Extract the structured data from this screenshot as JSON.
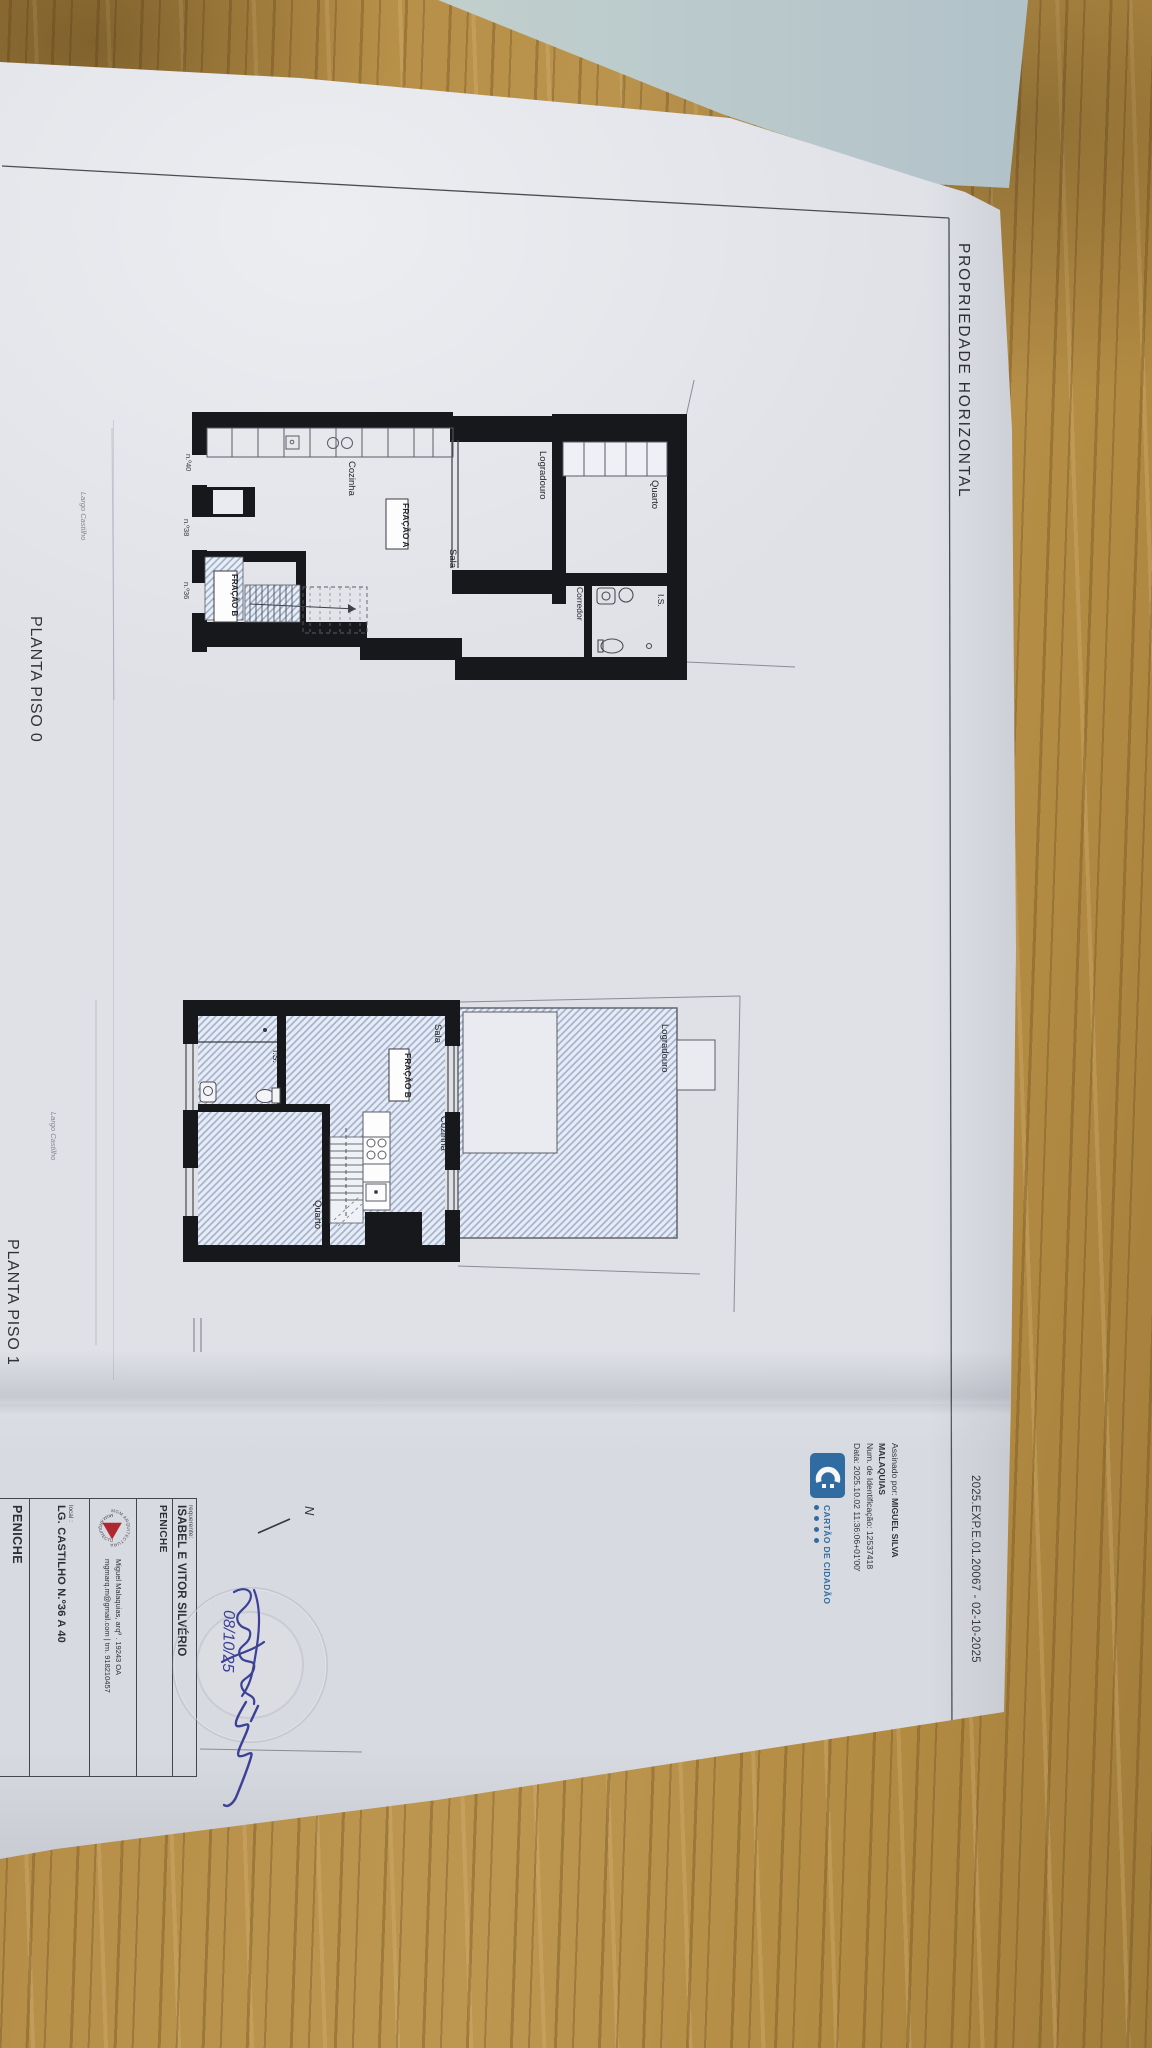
{
  "document": {
    "header": "PROPRIEDADE HORIZONTAL",
    "reference": "2025.EXP.E.01.20067 - 02-10-2025",
    "digital_signature": {
      "signed_by_label": "Assinado por:",
      "name_line1": "MIGUEL SILVA",
      "name_line2": "MALAQUIAS",
      "id_line": "Num. de Identificação: 12537418",
      "date_line": "Data: 2025.10.02 11:36:06+01'00'"
    },
    "citizen_card": {
      "wordmark": "CARTÃO DE CIDADÃO"
    },
    "plans": {
      "piso0": {
        "caption": "PLANTA PISO 0",
        "street_label": "Largo Castilho",
        "rooms": {
          "cozinha": "Cozinha",
          "sala": "Sala",
          "quarto": "Quarto",
          "corredor": "Corredor",
          "is": "I.S.",
          "logradouro": "Logradouro"
        },
        "fracao_a": "FRAÇÃO A",
        "fracao_b": "FRAÇÃO B",
        "doors": [
          "n.º40",
          "n.º38",
          "n.º36"
        ]
      },
      "piso1": {
        "caption": "PLANTA PISO 1",
        "street_label": "Largo Castilho",
        "rooms": {
          "sala": "Sala",
          "cozinha": "Cozinha",
          "quarto": "Quarto",
          "is": "I.S.",
          "logradouro": "Logradouro"
        },
        "fracao_b": "FRAÇÃO B"
      }
    },
    "title_block": {
      "requerente_label": "requerente:",
      "requerente": "ISABEL E VITOR SILVÉRIO",
      "municipality": "PENICHE",
      "studio_name": "MGM ARQUITECTURA",
      "architect_line": "Miguel Malaquias, arqº . 19243 OA",
      "contact_line": "mgmarq.m@gmail.com  |  tm. 918210457",
      "local_label": "local :",
      "address": "LG. CASTILHO N.º36 A 40",
      "location": "PENICHE"
    },
    "annotations": {
      "handwritten_date": "08/10/25",
      "north_label": "N"
    }
  },
  "colors": {
    "cc_blue": "#2e6da4",
    "mgm_red": "#b5242c",
    "ink_blue": "#3a3f99",
    "wall": "#17181c",
    "hatch_blue": "#9fb0cc"
  }
}
